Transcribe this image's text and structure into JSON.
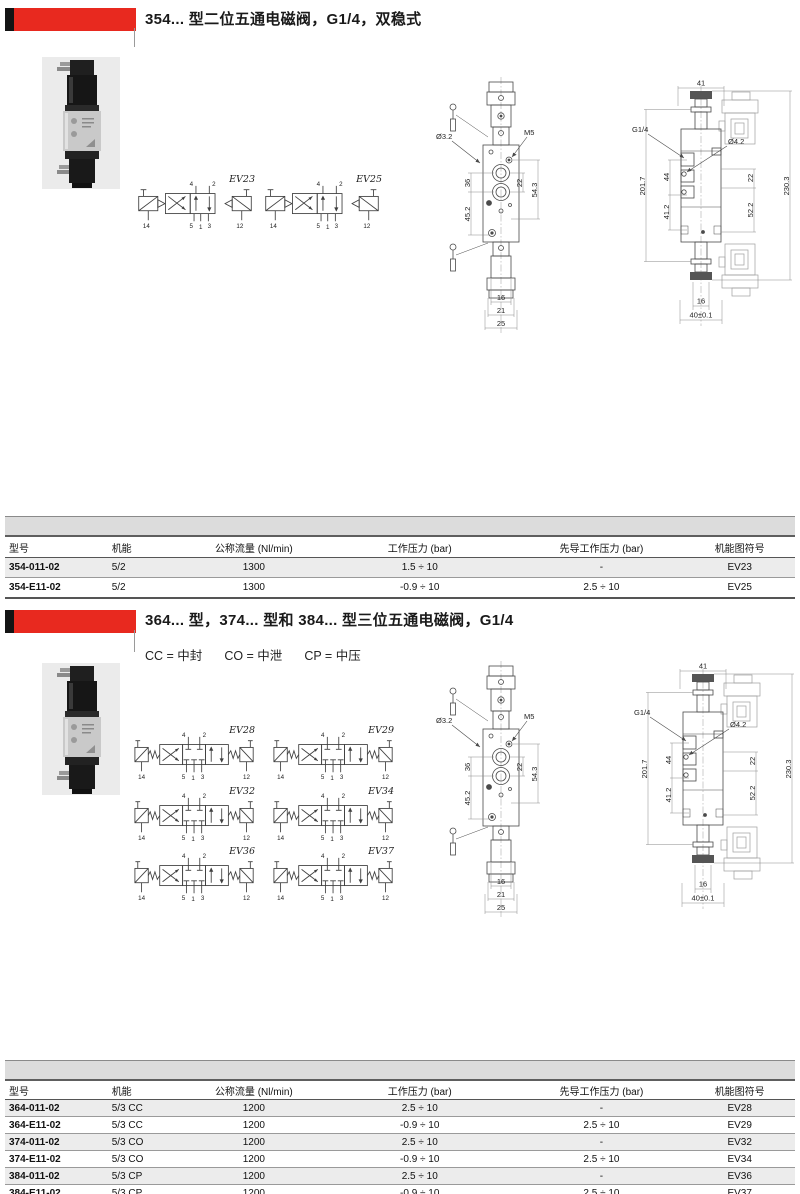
{
  "colors": {
    "accent_red": "#e8291f",
    "band_gray": "#dcdcdc",
    "row_gray": "#ececec"
  },
  "ports": {
    "p1": "1",
    "p2": "2",
    "p3": "3",
    "p4": "4",
    "p5": "5",
    "p12": "12",
    "p14": "14"
  },
  "front_view": {
    "dia_label": "Ø3.2",
    "thread_label": "M5",
    "dim_36": "36",
    "dim_45_2": "45.2",
    "dim_22": "22",
    "dim_54_3": "54.3",
    "dim_16": "16",
    "dim_21": "21",
    "dim_25": "25"
  },
  "side_view": {
    "dim_41": "41",
    "dim_201_7": "201.7",
    "thread_label": "G1/4",
    "dia_label": "Ø4.2",
    "dim_44": "44",
    "dim_41_2": "41.2",
    "dim_22": "22",
    "dim_52_2": "52.2",
    "dim_230_3": "230.3",
    "dim_16": "16",
    "dim_40": "40±0.1"
  },
  "section1": {
    "title": "354... 型二位五通电磁阀，G1/4，双稳式",
    "diagram_labels": [
      "EV23",
      "EV25"
    ],
    "table": {
      "headers": [
        "型号",
        "机能",
        "公称流量 (Nl/min)",
        "工作压力 (bar)",
        "先导工作压力 (bar)",
        "机能图符号"
      ],
      "rows": [
        [
          "354-011-02",
          "5/2",
          "1300",
          "1.5 ÷ 10",
          "-",
          "EV23"
        ],
        [
          "354-E11-02",
          "5/2",
          "1300",
          "-0.9 ÷ 10",
          "2.5 ÷ 10",
          "EV25"
        ]
      ]
    }
  },
  "section2": {
    "title": "364... 型，374... 型和 384... 型三位五通电磁阀，G1/4",
    "legend": [
      "CC = 中封",
      "CO = 中泄",
      "CP = 中压"
    ],
    "diagram_labels": [
      "EV28",
      "EV29",
      "EV32",
      "EV34",
      "EV36",
      "EV37"
    ],
    "table": {
      "headers": [
        "型号",
        "机能",
        "公称流量 (Nl/min)",
        "工作压力 (bar)",
        "先导工作压力 (bar)",
        "机能图符号"
      ],
      "rows": [
        [
          "364-011-02",
          "5/3 CC",
          "1200",
          "2.5 ÷ 10",
          "-",
          "EV28"
        ],
        [
          "364-E11-02",
          "5/3 CC",
          "1200",
          "-0.9 ÷ 10",
          "2.5 ÷ 10",
          "EV29"
        ],
        [
          "374-011-02",
          "5/3 CO",
          "1200",
          "2.5 ÷ 10",
          "-",
          "EV32"
        ],
        [
          "374-E11-02",
          "5/3 CO",
          "1200",
          "-0.9 ÷ 10",
          "2.5 ÷ 10",
          "EV34"
        ],
        [
          "384-011-02",
          "5/3 CP",
          "1200",
          "2.5 ÷ 10",
          "-",
          "EV36"
        ],
        [
          "384-E11-02",
          "5/3 CP",
          "1200",
          "-0.9 ÷ 10",
          "2.5 ÷ 10",
          "EV37"
        ]
      ]
    }
  }
}
